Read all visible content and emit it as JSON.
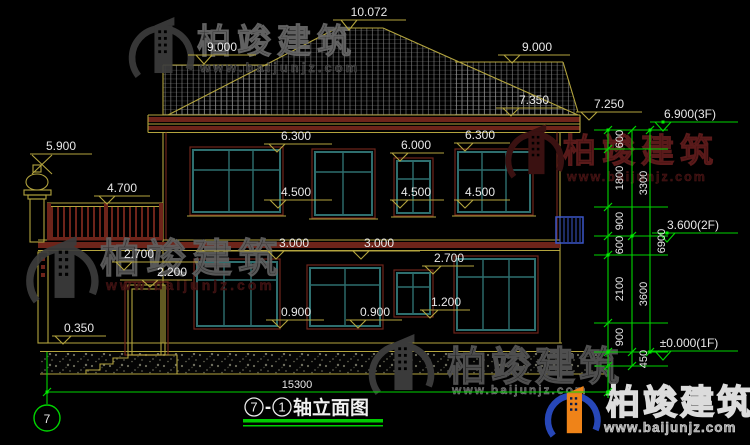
{
  "drawing": {
    "title": {
      "axis_from": "7",
      "dash": "-",
      "axis_to": "1",
      "name": "轴立面图"
    },
    "axis_bubble": "7",
    "watermark": {
      "brand": "柏竣建筑",
      "url": "www.baijunjz.com"
    },
    "levels": {
      "peak": "10.072",
      "ridge": "9.000",
      "upper_eave": "7.350",
      "eave": "7.250",
      "f3": "6.900(3F)",
      "f2": "3.600(2F)",
      "f1": "±0.000(1F)",
      "finial": "5.900",
      "railing": "4.700",
      "win2_head": "6.300",
      "win2_head_small": "6.000",
      "win2_sill": "4.500",
      "slab": "3.000",
      "win1_head": "2.700",
      "door_head": "2.200",
      "win1_sill": "0.900",
      "win1_sill_high": "1.200",
      "terrace": "0.350"
    },
    "chain": {
      "s600": "600",
      "s1800": "1800",
      "s900": "900",
      "s2100": "2100",
      "s450": "450",
      "t3300": "3300",
      "t3600": "3600",
      "t6900": "6900",
      "width": "15300"
    },
    "colors": {
      "line_yellow": "#b3a43e",
      "maroon": "#6e241a",
      "teal": "#2e6f6f",
      "green": "#00d500",
      "text": "#e8e8e8",
      "blue": "#3a56c8",
      "background": "#000000"
    }
  }
}
